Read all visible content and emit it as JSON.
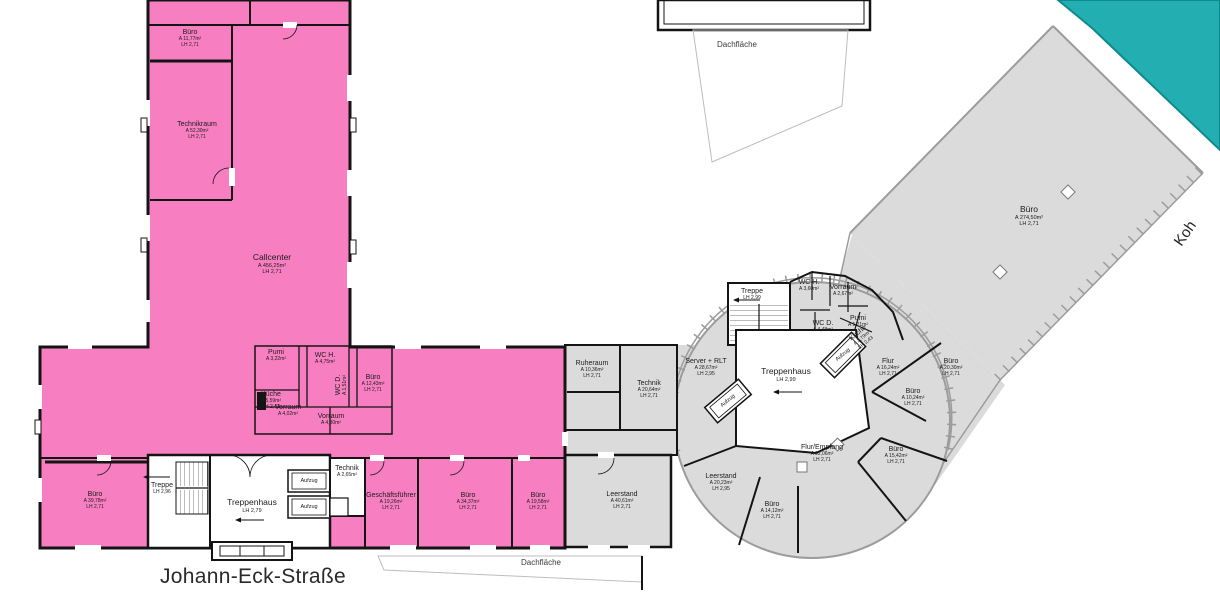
{
  "plan": {
    "type": "floor-plan",
    "colors": {
      "unit_pink": "#F77FC1",
      "unit_teal": "#23AEB1",
      "floor_gray": "#DBDBDB",
      "wall_dark": "#141414",
      "wall_gray": "#9C9C9C"
    }
  },
  "misc": {
    "aufzug": "Aufzug",
    "roof_top": "Dachfläche",
    "roof_bottom": "Dachfläche",
    "street": "Johann-Eck-Straße",
    "street_right": "Koh"
  },
  "rooms": [
    {
      "name": "Büro",
      "area": "A 11,77m²",
      "lh": "LH 2,71"
    },
    {
      "name": "Technikraum",
      "area": "A 52,30m²",
      "lh": "LH 2,71"
    },
    {
      "name": "Callcenter",
      "area": "A 456,25m²",
      "lh": "LH 2,71"
    },
    {
      "name": "Pumi",
      "area": "A 3,22m²",
      "lh": ""
    },
    {
      "name": "WC H.",
      "area": "A 4,75m²",
      "lh": ""
    },
    {
      "name": "Küche",
      "area": "A 5,59m²",
      "lh": "LH 2,43"
    },
    {
      "name": "Vorraum",
      "area": "A 4,02m²",
      "lh": ""
    },
    {
      "name": "WC D.",
      "area": "A 1,51m²",
      "lh": ""
    },
    {
      "name": "Vorraum",
      "area": "A 4,30m²",
      "lh": ""
    },
    {
      "name": "Büro",
      "area": "A 12,43m²",
      "lh": "LH 2,71"
    },
    {
      "name": "Büro",
      "area": "A 39,78m²",
      "lh": "LH 2,71"
    },
    {
      "name": "Treppe",
      "area": "",
      "lh": "LH 2,96"
    },
    {
      "name": "Treppenhaus",
      "area": "",
      "lh": "LH 2,79"
    },
    {
      "name": "Technik",
      "area": "A 2,65m²",
      "lh": ""
    },
    {
      "name": "Geschäftsführer",
      "area": "A 19,26m²",
      "lh": "LH 2,71"
    },
    {
      "name": "Büro",
      "area": "A 34,37m²",
      "lh": "LH 2,71"
    },
    {
      "name": "Büro",
      "area": "A 19,58m²",
      "lh": "LH 2,71"
    },
    {
      "name": "Ruheraum",
      "area": "A 10,36m²",
      "lh": "LH 2,71"
    },
    {
      "name": "Technik",
      "area": "A 20,64m²",
      "lh": "LH 2,71"
    },
    {
      "name": "Server + RLT",
      "area": "A 28,67m²",
      "lh": "LH 2,95"
    },
    {
      "name": "Treppenhaus",
      "area": "",
      "lh": "LH 2,99"
    },
    {
      "name": "Leerstand",
      "area": "A 40,61m²",
      "lh": "LH 2,71"
    },
    {
      "name": "Leerstand",
      "area": "A 20,23m²",
      "lh": "LH 2,95"
    },
    {
      "name": "Büro",
      "area": "A 14,12m²",
      "lh": "LH 2,71"
    },
    {
      "name": "Flur/Empfang",
      "area": "A 92,06m²",
      "lh": "LH 2,71"
    },
    {
      "name": "Büro",
      "area": "A 15,42m²",
      "lh": "LH 2,71"
    },
    {
      "name": "Treppe",
      "area": "",
      "lh": "LH 2,99"
    },
    {
      "name": "WC H.",
      "area": "A 3,60m²",
      "lh": ""
    },
    {
      "name": "Vorraum",
      "area": "A 2,67m²",
      "lh": ""
    },
    {
      "name": "WC D.",
      "area": "A 4,48m²",
      "lh": ""
    },
    {
      "name": "Pumi",
      "area": "A 1,21m²",
      "lh": ""
    },
    {
      "name": "Küche",
      "area": "A 2,79m²",
      "lh": "LH 2,43"
    },
    {
      "name": "Flur",
      "area": "A 16,24m²",
      "lh": "LH 2,71"
    },
    {
      "name": "Büro",
      "area": "A 20,30m²",
      "lh": "LH 2,71"
    },
    {
      "name": "Büro",
      "area": "A 10,24m²",
      "lh": "LH 2,71"
    },
    {
      "name": "Büro",
      "area": "A 274,50m²",
      "lh": "LH 2,71"
    }
  ]
}
